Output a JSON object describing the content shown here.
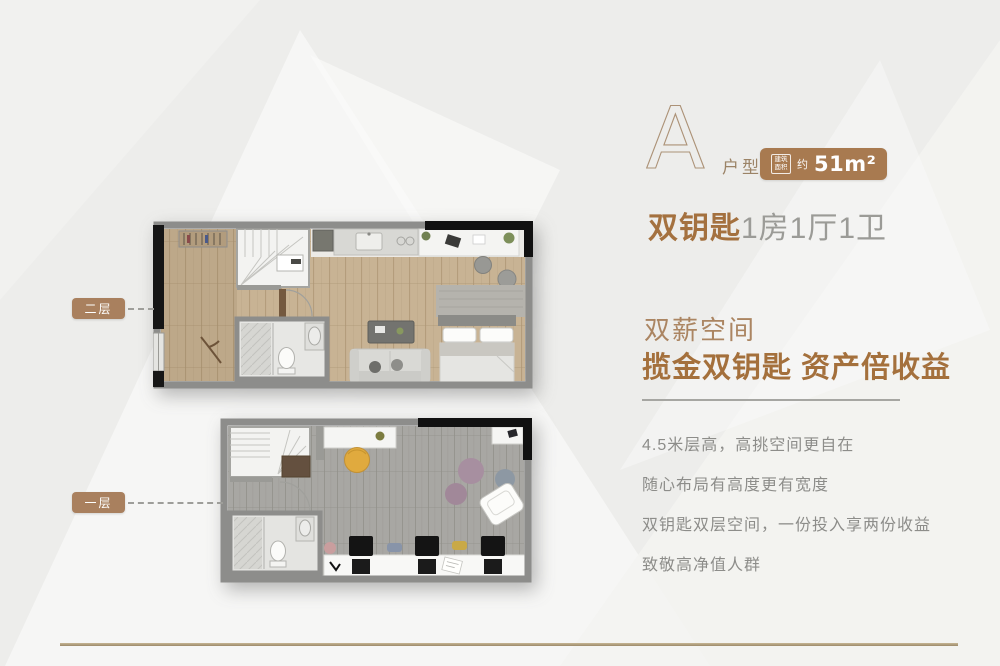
{
  "palette": {
    "background": "#ededeb",
    "accent_brown": "#a4713f",
    "badge_bg": "#a87a50",
    "pill_bg": "#a9805e",
    "gold_line": "#ab9878",
    "text_gray": "#8d8d8a"
  },
  "header": {
    "type_letter": "A",
    "type_suffix": "户型",
    "badge": {
      "box_label": "建筑面积",
      "approx": "约",
      "area": "51m²"
    },
    "title_bold": "双钥匙",
    "title_light": "1房1厅1卫"
  },
  "floorplans": {
    "upper_label": "二层",
    "lower_label": "一层"
  },
  "slogan": {
    "line1": "双薪空间",
    "line2": "揽金双钥匙 资产倍收益"
  },
  "features": [
    "4.5米层高，高挑空间更自在",
    "随心布局有高度更有宽度",
    "双钥匙双层空间，一份投入享两份收益",
    "致敬高净值人群"
  ]
}
